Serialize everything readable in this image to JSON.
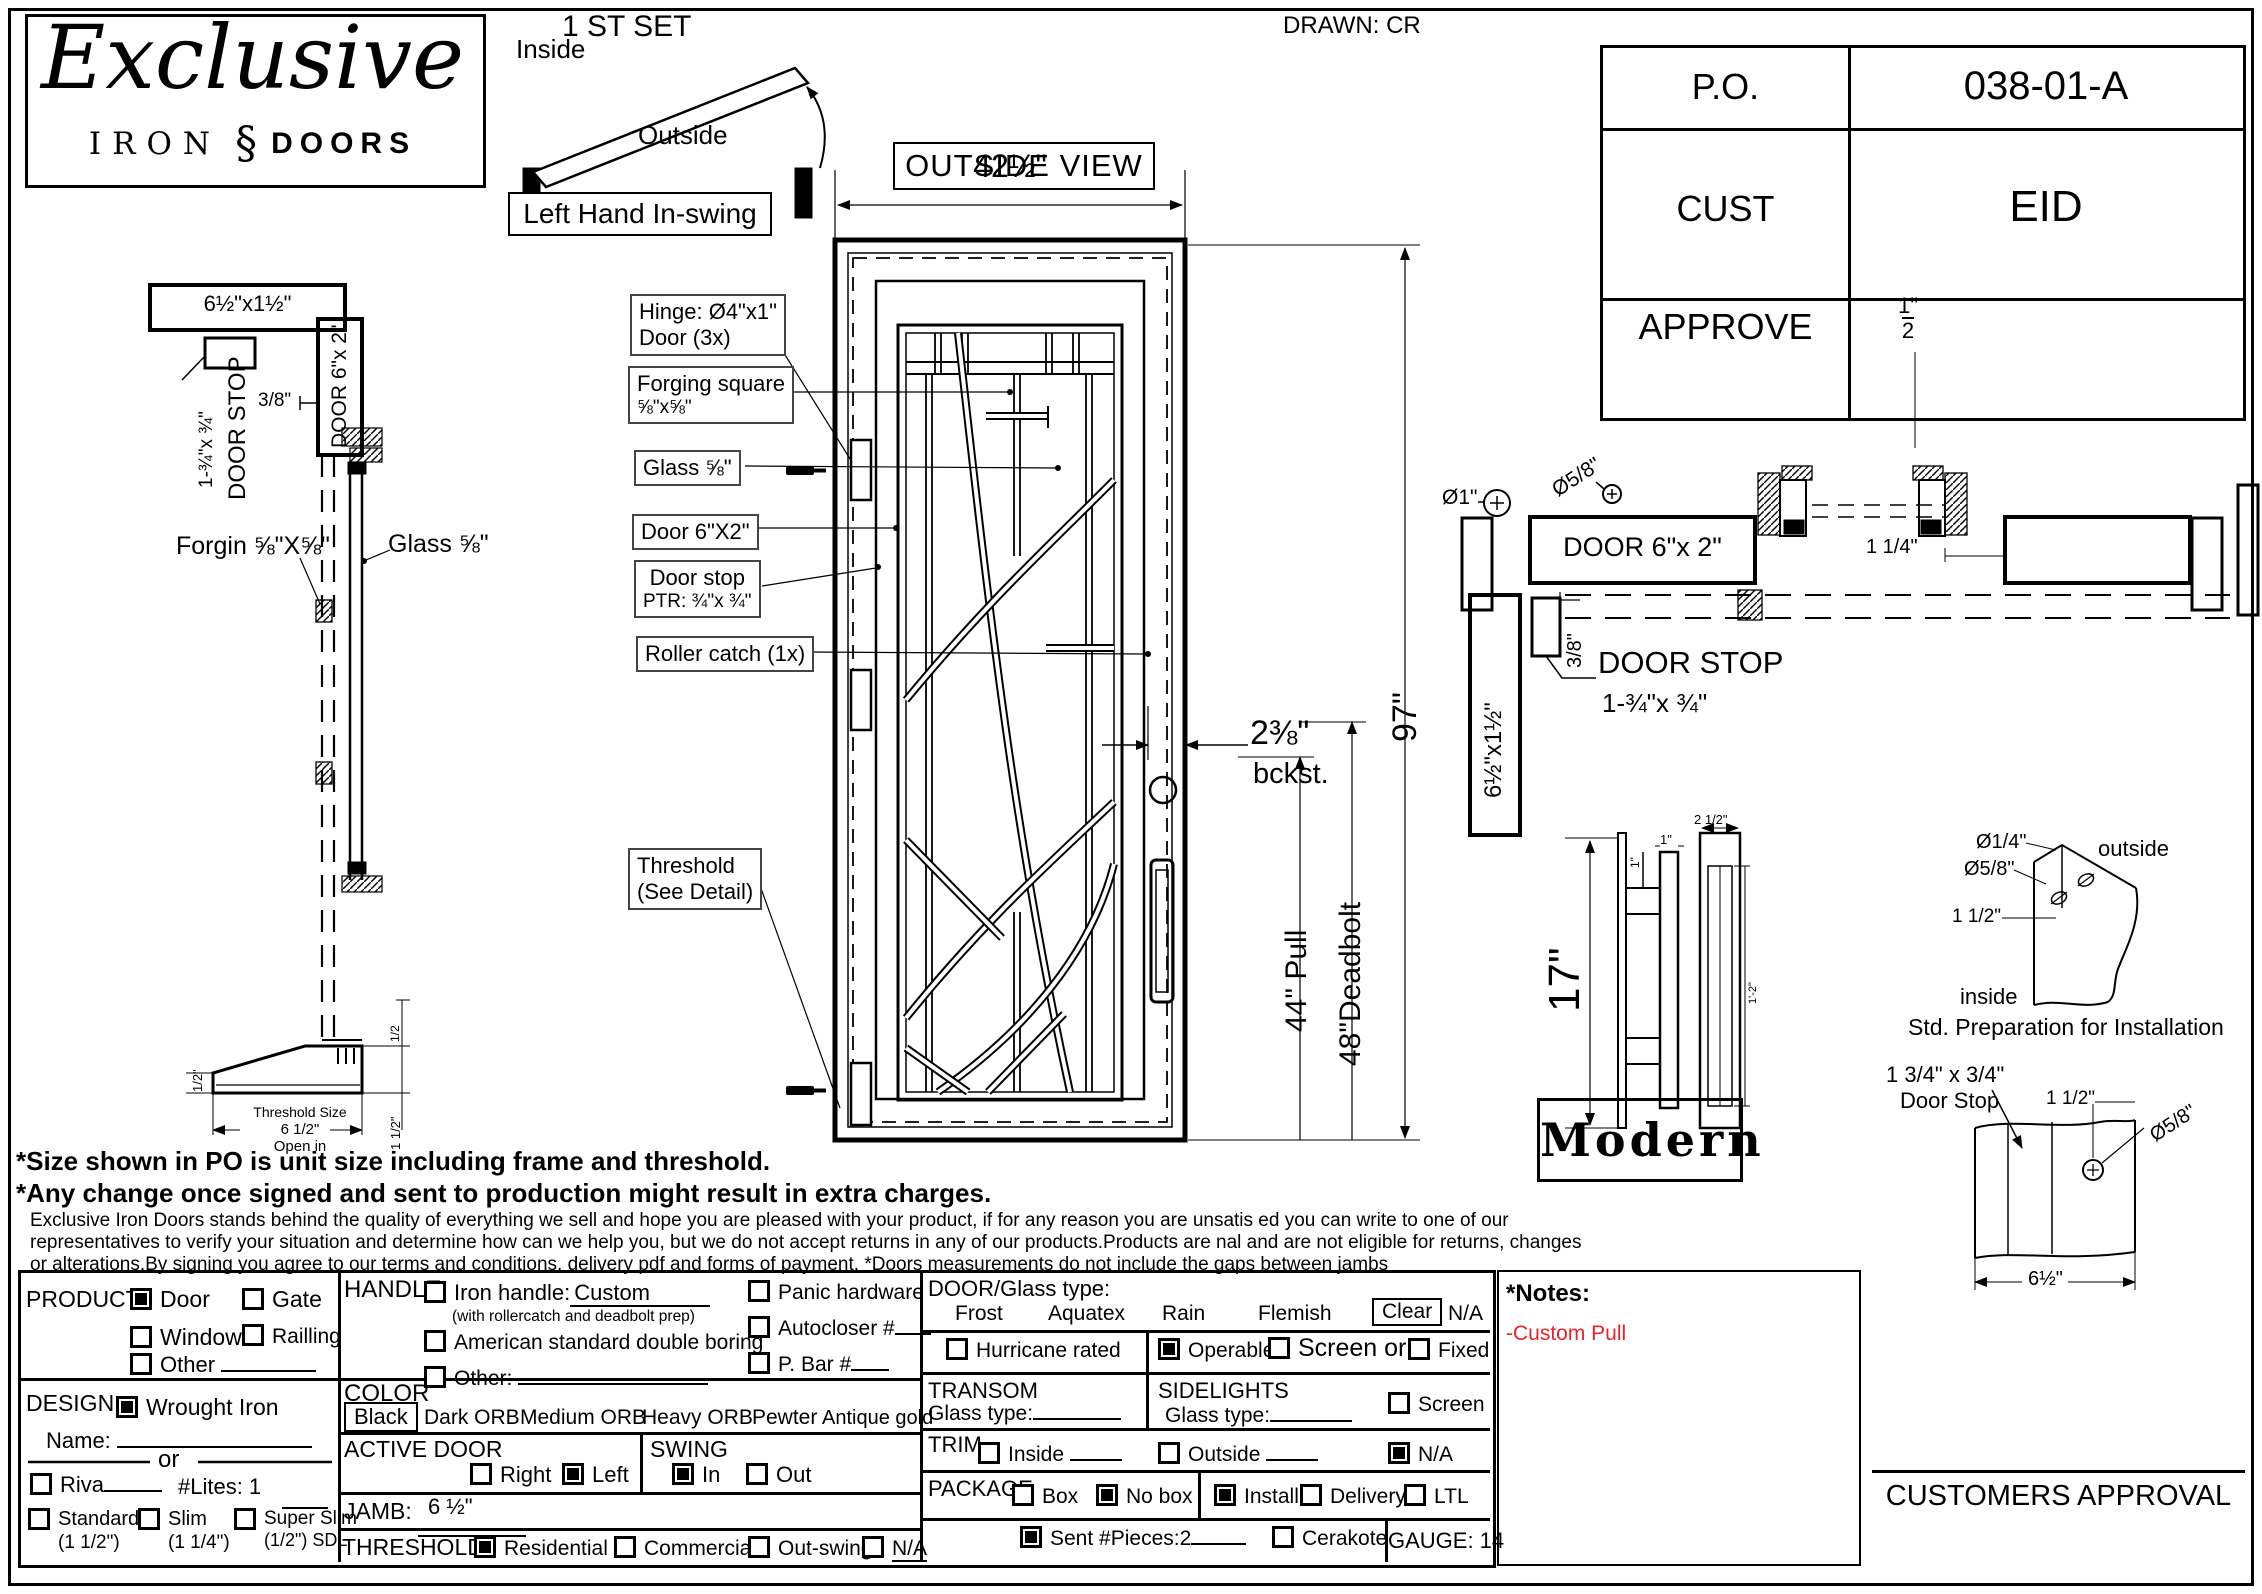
{
  "logo": {
    "script": "Exclusive",
    "iron": "IRON",
    "glyph": "§",
    "doors": "DOORS"
  },
  "drawn": "DRAWN: CR",
  "po_table": {
    "rows": [
      {
        "label": "P.O.",
        "value": "038-01-A"
      },
      {
        "label": "CUST",
        "value": "EID"
      },
      {
        "label": "APPROVE",
        "value": ""
      }
    ]
  },
  "swing": {
    "title": "1 ST SET",
    "inside": "Inside",
    "outside": "Outside",
    "caption": "Left Hand In-swing"
  },
  "outside_view": "OUTSIDE VIEW",
  "left_section": {
    "head_dim": "6½\"x1½\"",
    "door_stop_l1": "DOOR STOP",
    "door_stop_l2": "1-¾\"x ¾\"",
    "three_eighths": "3/8\"",
    "jamb": "DOOR 6\"x 2\"",
    "forging": "Forgin ⅝\"X⅝\"",
    "glass": "Glass ⅝\"",
    "half_left": "1/2\"",
    "half_right": "1/2",
    "thr1": "Threshold Size",
    "thr2": "6 1/2\"",
    "thr3": "Open in",
    "one_half_right": "1 1/2\""
  },
  "elevation": {
    "width_dim": "42½\"",
    "height_dim": "97\"",
    "backset_l1": "2⅜\"",
    "backset_l2": "bckst.",
    "pull_dim": "44\" Pull",
    "deadbolt_dim": "48\"Deadbolt",
    "callouts": [
      {
        "l1": "Hinge: Ø4\"x1\"",
        "l2": "Door (3x)"
      },
      {
        "l1": "Forging square",
        "l2": "⅝\"x⅝\""
      },
      {
        "l1": "Glass ⅝\"",
        "l2": ""
      },
      {
        "l1": "Door  6\"X2\"",
        "l2": ""
      },
      {
        "l1": "Door stop",
        "l2": "PTR: ¾\"x ¾\""
      },
      {
        "l1": "Roller catch  (1x)",
        "l2": ""
      },
      {
        "l1": "Threshold",
        "l2": "(See Detail)"
      }
    ]
  },
  "plan": {
    "dia_one": "Ø1\"",
    "dia58": "Ø5/8\"",
    "half_num": "1\"",
    "half_den": "2",
    "door_label": "DOOR 6\"x 2\"",
    "one_quarter": "1 1/4\"",
    "head_dim": "6½\"x1½\"",
    "three_eighths": "3/8\"",
    "door_stop_l1": "DOOR STOP",
    "door_stop_l2": "1-¾\"x ¾\""
  },
  "pull_detail": {
    "height": "17\"",
    "one_a": "1\"",
    "one_b": "1\"",
    "width": "2 1/2\"",
    "inner": "1'-2\"",
    "name": "Modern"
  },
  "install_detail": {
    "dia_quarter": "Ø1/4\"",
    "dia58": "Ø5/8\"",
    "offset": "1 1/2\"",
    "outside": "outside",
    "inside": "inside",
    "caption": "Std. Preparation for Installation"
  },
  "stop_detail": {
    "size_l1": "1 3/4\" x 3/4\"",
    "size_l2": "Door Stop",
    "offset": "1 1/2\"",
    "dia": "Ø5/8\"",
    "width": "6½\""
  },
  "notes": {
    "bold1": "*Size shown in PO is unit size including frame and threshold.",
    "bold2": "*Any change once signed and sent to production might result in extra charges.",
    "small1": "Exclusive Iron Doors stands behind the quality of everything we sell and hope you are pleased with your product, if for any reason you are unsatis    ed you can write to one of our",
    "small2": "representatives to verify your situation and determine how can we help you, but we do not accept returns in any of our products.Products are     nal and are not eligible for returns, changes",
    "small3": "or alterations.By signing you agree to our terms and conditions, delivery pdf and forms of payment. *Doors measurements do not include the gaps between jambs"
  },
  "form": {
    "product": {
      "label": "PRODUCT:",
      "door": "Door",
      "door_checked": true,
      "gate": "Gate",
      "gate_checked": false,
      "window": "Window",
      "window_checked": false,
      "railling": "Railling",
      "railling_checked": false,
      "other": "Other",
      "other_checked": false
    },
    "design": {
      "label": "DESIGN:",
      "wrought": "Wrought Iron",
      "wrought_checked": true,
      "name_label": "Name:",
      "or": "or",
      "riva": "Riva",
      "riva_checked": false,
      "lites": "#Lites: 1",
      "standard": "Standard",
      "standard_sub": "(1 1/2\")",
      "standard_checked": false,
      "slim": "Slim",
      "slim_sub": "(1 1/4\")",
      "slim_checked": false,
      "superslim": "Super Slim",
      "superslim_sub": "(1/2\") SDL",
      "superslim_checked": false
    },
    "handle": {
      "label": "HANDLE",
      "iron": "Iron handle:",
      "iron_value": "Custom",
      "iron_checked": false,
      "prep": "(with rollercatch and deadbolt prep)",
      "american": "American standard double boring",
      "american_checked": false,
      "other": "Other:",
      "other_checked": false,
      "panic": "Panic hardware",
      "panic_checked": false,
      "autocloser": "Autocloser #",
      "autocloser_checked": false,
      "pbar": "P. Bar #",
      "pbar_checked": false
    },
    "color": {
      "label": "COLOR",
      "selected": "Black",
      "opt1": "Dark ORB",
      "opt2": "Medium ORB",
      "opt3": "Heavy ORB",
      "opt4": "Pewter",
      "opt5": "Antique gold"
    },
    "active_door": {
      "label": "ACTIVE DOOR",
      "right": "Right",
      "right_checked": false,
      "left": "Left",
      "left_checked": true
    },
    "swing": {
      "label": "SWING",
      "in": "In",
      "in_checked": true,
      "out": "Out",
      "out_checked": false
    },
    "jamb": {
      "label": "JAMB:",
      "value": "6 ½\""
    },
    "threshold": {
      "label": "THRESHOLD",
      "residential": "Residential",
      "residential_checked": true,
      "commercial": "Commercial",
      "commercial_checked": false,
      "outswing": "Out-swing",
      "outswing_checked": false,
      "na": "N/A",
      "na_checked": false
    },
    "glass": {
      "label": "DOOR/Glass type:",
      "frost": "Frost",
      "aquatex": "Aquatex",
      "rain": "Rain",
      "flemish": "Flemish",
      "clear": "Clear",
      "na": "N/A"
    },
    "hurricane": {
      "label": "Hurricane rated",
      "checked": false
    },
    "operable": {
      "label": "Operable",
      "checked": true
    },
    "screen_or": {
      "label": "Screen or",
      "checked": false
    },
    "fixed": {
      "label": "Fixed",
      "checked": false
    },
    "transom": {
      "label": "TRANSOM",
      "glass": "Glass type:"
    },
    "sidelights": {
      "label": "SIDELIGHTS",
      "glass": "Glass type:",
      "screen": "Screen",
      "screen_checked": false
    },
    "trim": {
      "label": "TRIM",
      "inside": "Inside",
      "inside_checked": false,
      "outside": "Outside",
      "outside_checked": false,
      "na": "N/A",
      "na_checked": true
    },
    "package": {
      "label": "PACKAGE",
      "box": "Box",
      "box_checked": false,
      "nobox": "No box",
      "nobox_checked": true,
      "install": "Install",
      "install_checked": true,
      "delivery": "Delivery",
      "delivery_checked": false,
      "ltl": "LTL",
      "ltl_checked": false
    },
    "sent": {
      "label": "Sent #Pieces:",
      "value": "2",
      "checked": true
    },
    "cerakote": {
      "label": "Cerakote",
      "checked": false
    },
    "gauge": "GAUGE: 14"
  },
  "notes_panel": {
    "title": "*Notes:",
    "note": "-Custom Pull",
    "note_color": "#e8242a"
  },
  "approval": "CUSTOMERS APPROVAL"
}
